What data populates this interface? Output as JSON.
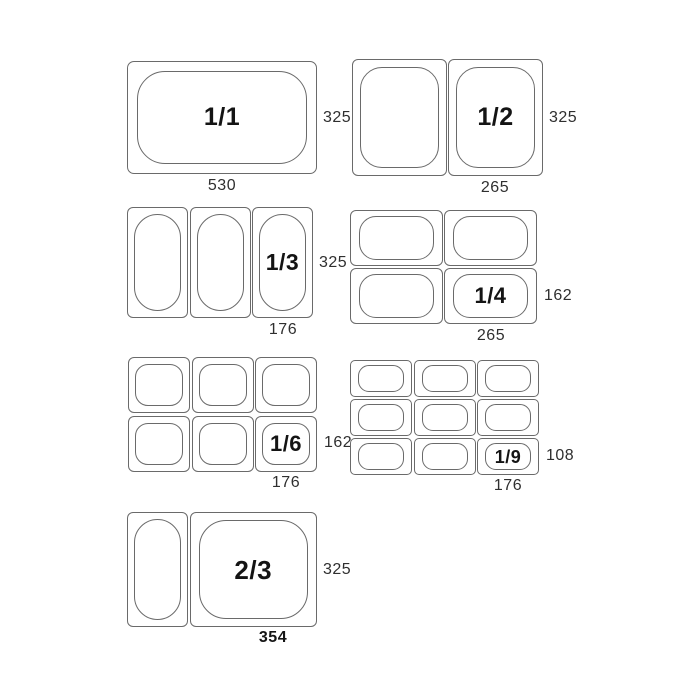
{
  "colors": {
    "background": "#ffffff",
    "line": "#6a6a6a",
    "dimension_text": "#2f2f2f",
    "fraction_text": "#141414"
  },
  "diagrams": {
    "gn11": {
      "label": "1/1",
      "side_dim": "325",
      "bottom_dim": "530"
    },
    "gn12": {
      "label": "1/2",
      "side_dim": "325",
      "bottom_dim": "265"
    },
    "gn13": {
      "label": "1/3",
      "side_dim": "325",
      "bottom_dim": "176"
    },
    "gn14": {
      "label": "1/4",
      "side_dim": "162",
      "bottom_dim": "265"
    },
    "gn16": {
      "label": "1/6",
      "side_dim": "162",
      "bottom_dim": "176"
    },
    "gn19": {
      "label": "1/9",
      "side_dim": "108",
      "bottom_dim": "176"
    },
    "gn23": {
      "label": "2/3",
      "side_dim": "325",
      "bottom_dim": "354"
    }
  }
}
